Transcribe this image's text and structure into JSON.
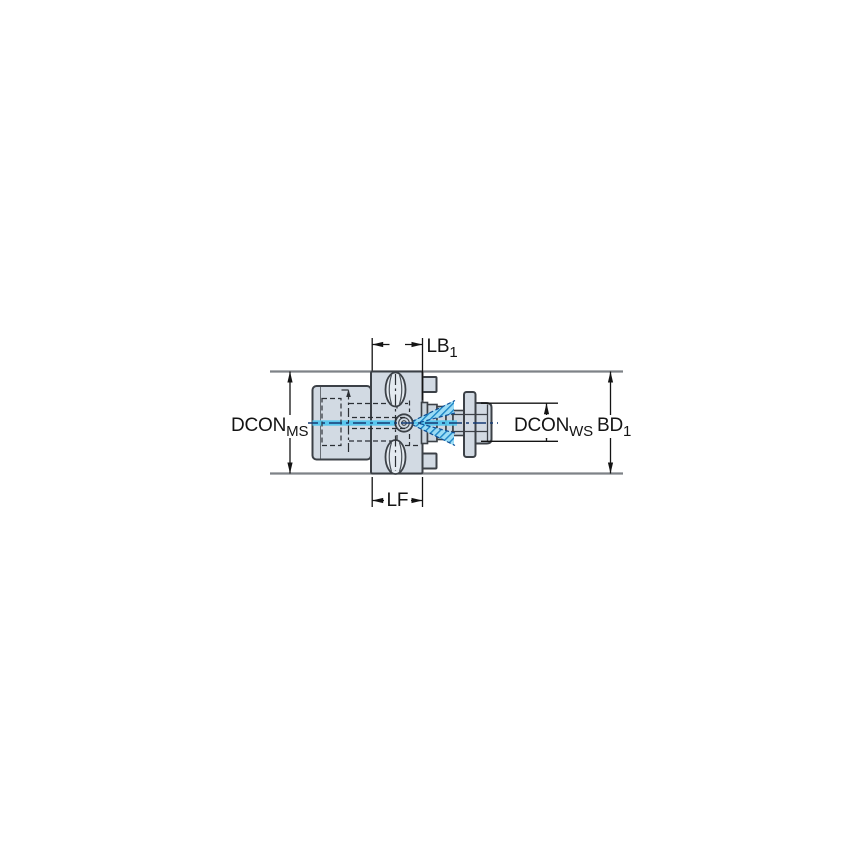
{
  "drawing": {
    "kind": "tool-adapter-dimension-drawing",
    "labels": {
      "lb1": {
        "main": "LB",
        "sub": "1"
      },
      "lf": {
        "main": "LF",
        "sub": ""
      },
      "dcon_ms": {
        "main": "DCON",
        "sub": "MS"
      },
      "dcon_ws": {
        "main": "DCON",
        "sub": "WS"
      },
      "bd1": {
        "main": "BD",
        "sub": "1"
      }
    },
    "colors": {
      "background": "#ffffff",
      "body_fill": "#d2dae3",
      "slot_fill": "#e4eaf0",
      "outline": "#3c4147",
      "extension_line": "#7e8287",
      "dimension_line": "#141414",
      "centerline_blue": "#143b75",
      "coolant_cyan": "#53c6ee",
      "cone_fill": "#9bdcf5",
      "cone_hatch_blue": "#1d86c6"
    }
  }
}
